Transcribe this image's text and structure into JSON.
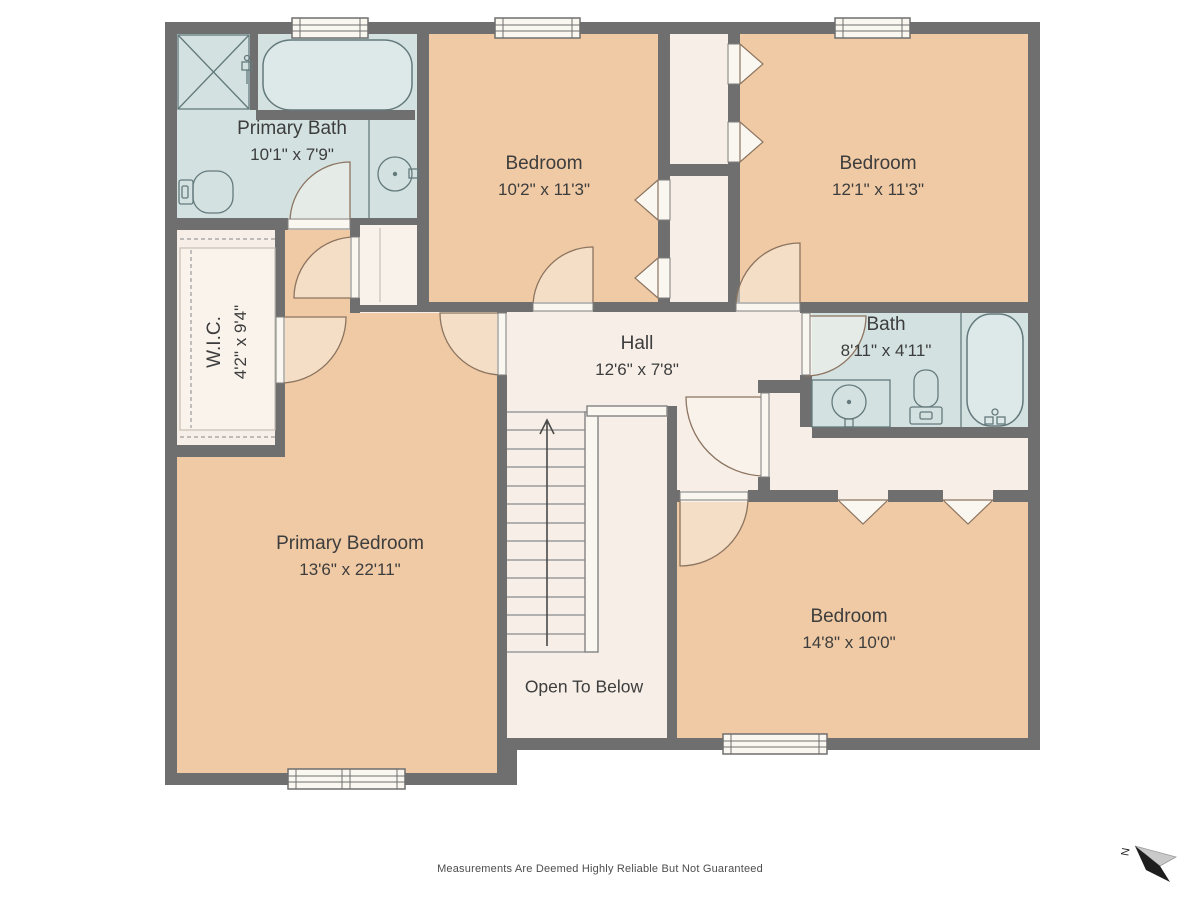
{
  "meta": {
    "footer": "Measurements Are Deemed Highly Reliable But Not Guaranteed",
    "compass_label": "N"
  },
  "colors": {
    "wall": "#6f6f6f",
    "bedroom": "#efcaa4",
    "bathroom": "#d3e2e1",
    "floor": "#f7efe7",
    "leaf-fill": "#faf7f1",
    "fixture-fill": "#dde9e8",
    "fixture-stroke": "#64797c",
    "door-fill": "rgba(250,246,240,0.45)",
    "door-stroke": "#8c7460",
    "stair-line": "#9b9b9b",
    "dash": "#9b9b9b",
    "text": "#3d3d3d"
  },
  "rooms": {
    "primary_bath": {
      "name": "Primary Bath",
      "dims": "10'1\" x 7'9\""
    },
    "bedroom_top_middle": {
      "name": "Bedroom",
      "dims": "10'2\" x 11'3\""
    },
    "bedroom_top_right": {
      "name": "Bedroom",
      "dims": "12'1\" x 11'3\""
    },
    "wic": {
      "name": "W.I.C.",
      "dims": "4'2\" x 9'4\""
    },
    "hall": {
      "name": "Hall",
      "dims": "12'6\" x 7'8\""
    },
    "bath": {
      "name": "Bath",
      "dims": "8'11\" x 4'11\""
    },
    "primary_bedroom": {
      "name": "Primary Bedroom",
      "dims": "13'6\" x 22'11\""
    },
    "bedroom_bottom_right": {
      "name": "Bedroom",
      "dims": "14'8\" x 10'0\""
    },
    "stairwell": {
      "label": "Open To Below"
    }
  }
}
